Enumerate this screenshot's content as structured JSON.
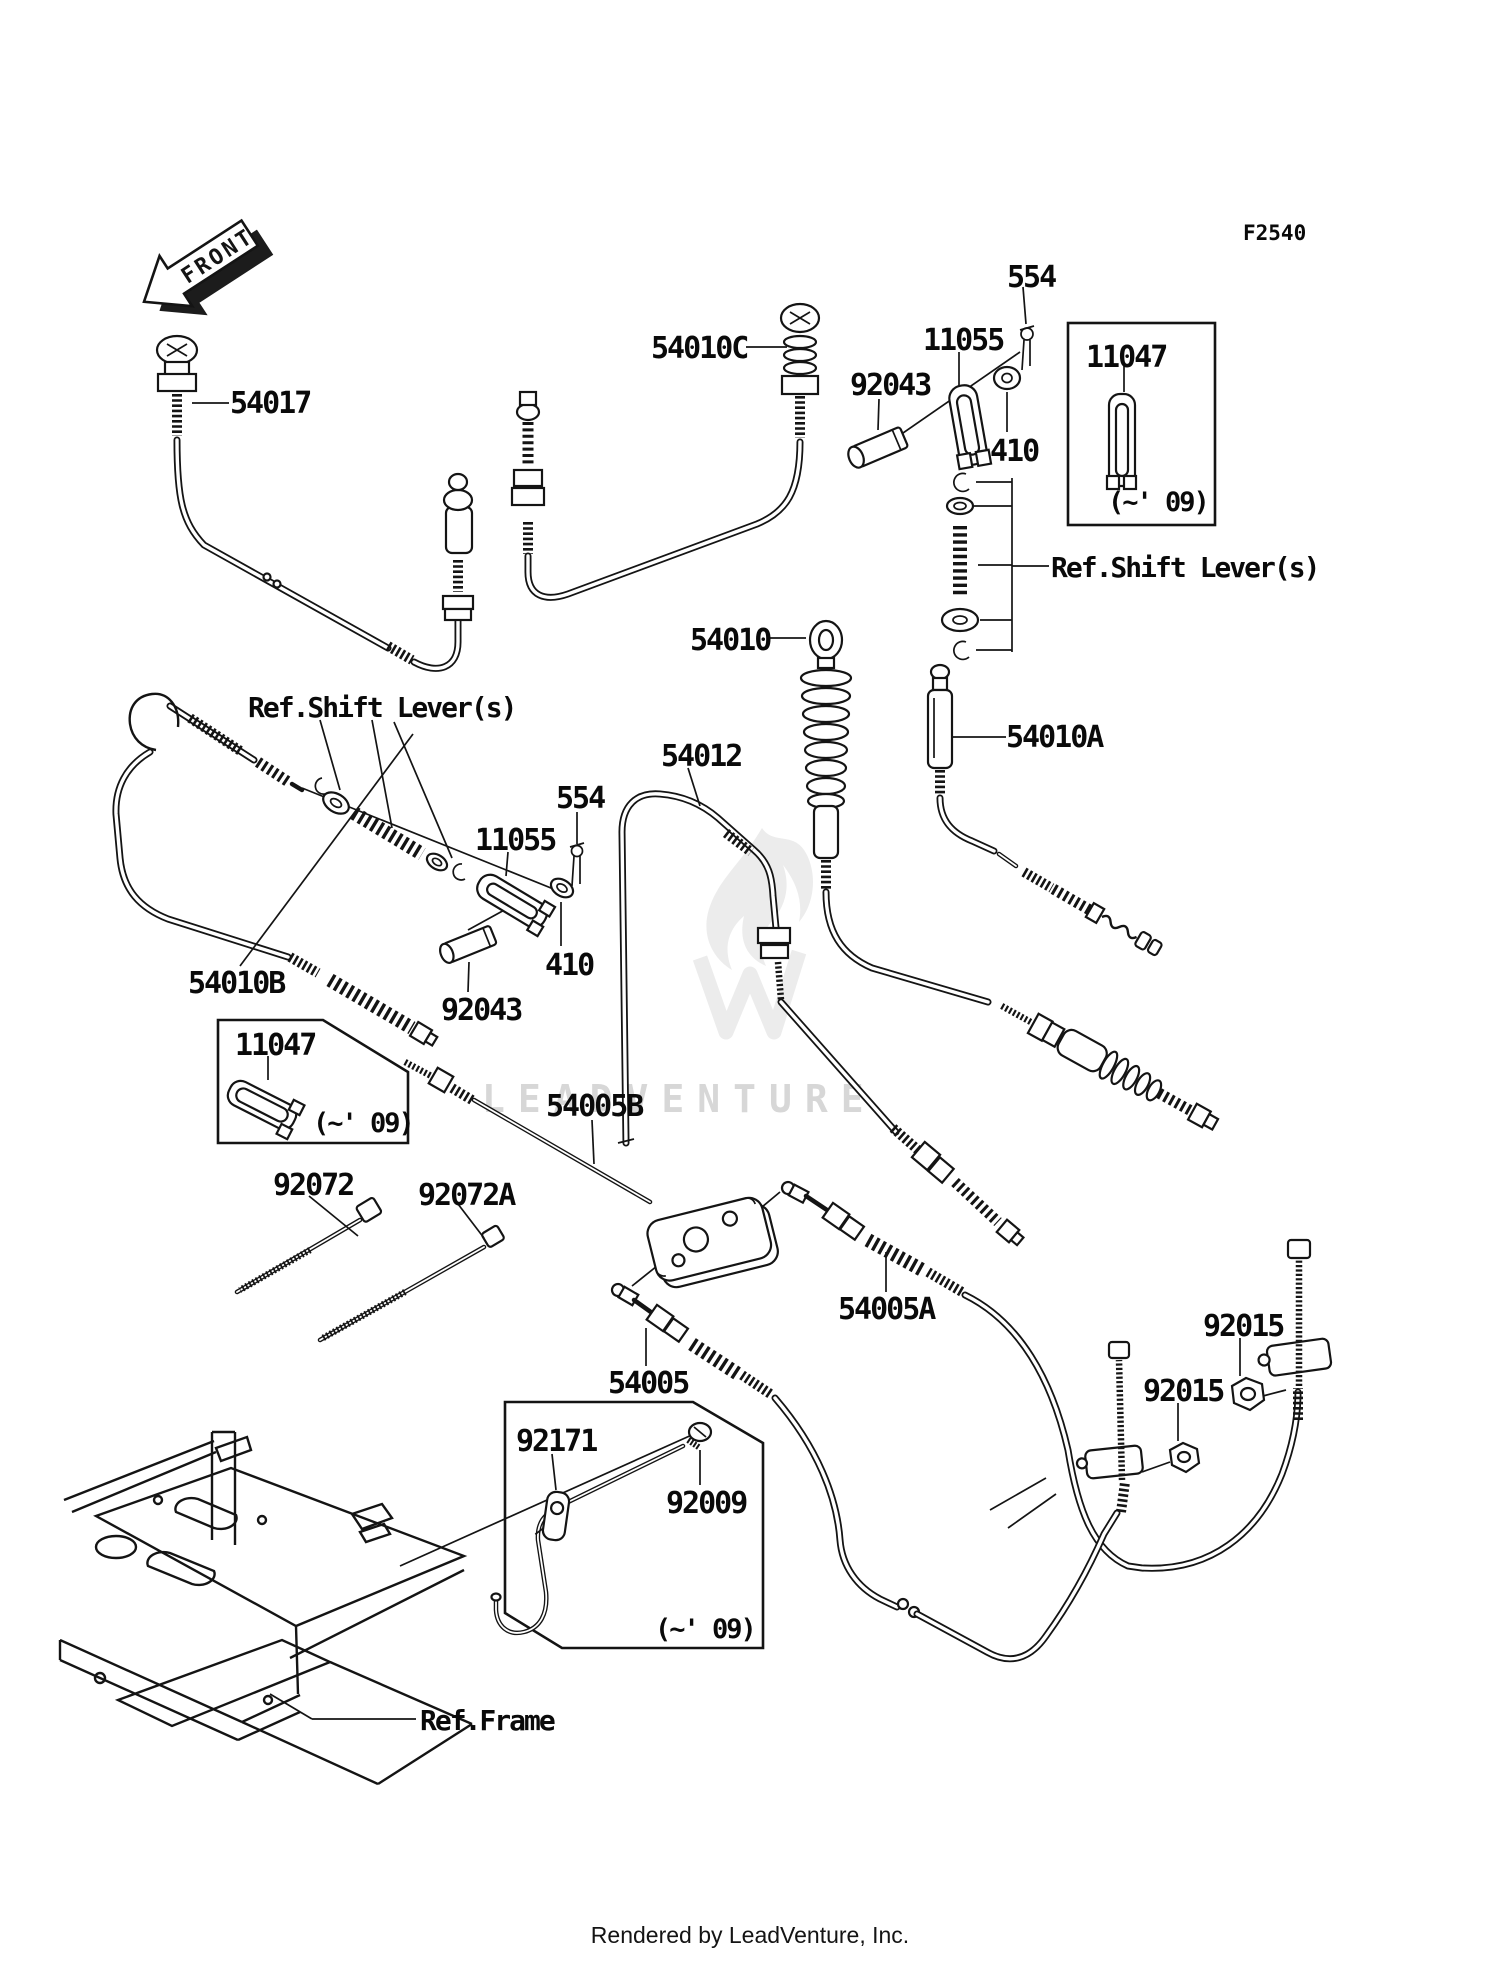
{
  "diagram": {
    "code": "F2540",
    "type": "parts-exploded-diagram",
    "subject": "Cables"
  },
  "front_arrow": {
    "label": "FRONT"
  },
  "watermark": {
    "text": "LEADVENTURE"
  },
  "footer": {
    "credit": "Rendered by LeadVenture, Inc."
  },
  "labels": {
    "p54017": "54017",
    "p54010C": "54010C",
    "p92043_top": "92043",
    "p11055_top": "11055",
    "p554_top": "554",
    "p410_top": "410",
    "p11047_top": "11047",
    "note09_top": "(~' 09)",
    "ref_shift_right": "Ref.Shift Lever(s)",
    "p54010": "54010",
    "p54010A": "54010A",
    "p54012": "54012",
    "p554_mid": "554",
    "p11055_mid": "11055",
    "p410_mid": "410",
    "p92043_mid": "92043",
    "ref_shift_left": "Ref.Shift Lever(s)",
    "p54010B": "54010B",
    "p11047_left": "11047",
    "note09_left": "(~' 09)",
    "p92072": "92072",
    "p92072A": "92072A",
    "p54005B": "54005B",
    "p54005A": "54005A",
    "p54005": "54005",
    "p92015_right": "92015",
    "p92015_left": "92015",
    "p92171": "92171",
    "p92009": "92009",
    "note09_bottom": "(~' 09)",
    "ref_frame": "Ref.Frame"
  }
}
